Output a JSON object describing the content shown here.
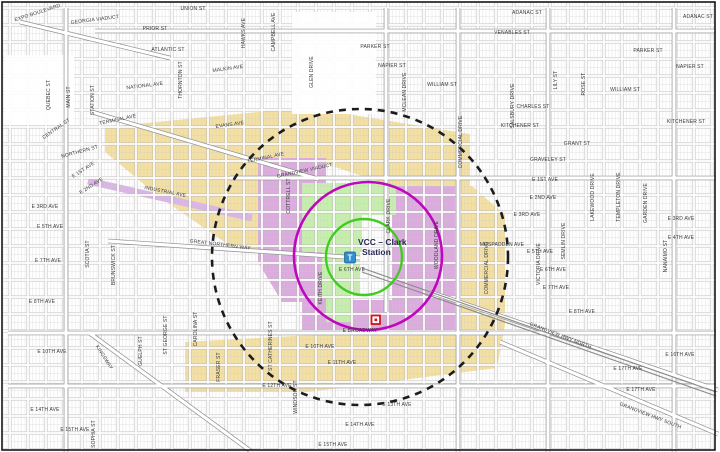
{
  "map": {
    "station": {
      "line1": "VCC – Clark",
      "line2": "Station",
      "icon_letter": "T"
    },
    "circles": {
      "inner": {
        "color": "#3fcb1f"
      },
      "middle": {
        "color": "#bd08bd"
      },
      "outer": {
        "color": "#1c1c1c"
      }
    },
    "zone_colors": {
      "tan": "#f4e0a1",
      "purple": "#dcaade",
      "green": "#c6efac",
      "lavender": "#dab4e6"
    },
    "marker_color": "#cf1418",
    "station_icon_color": "#2f8fd0",
    "street_labels": [
      {
        "t": "EXPO BOULEVARD",
        "x": 38,
        "y": 14,
        "r": -18
      },
      {
        "t": "GEORGIA VIADUCT",
        "x": 95,
        "y": 21,
        "r": -7
      },
      {
        "t": "UNION ST",
        "x": 193,
        "y": 10,
        "r": 0
      },
      {
        "t": "ADANAC ST",
        "x": 527,
        "y": 14,
        "r": 0
      },
      {
        "t": "ADANAC ST",
        "x": 698,
        "y": 18,
        "r": 0
      },
      {
        "t": "PRIOR ST",
        "x": 155,
        "y": 30,
        "r": 0
      },
      {
        "t": "VENABLES ST",
        "x": 512,
        "y": 34,
        "r": 0
      },
      {
        "t": "ATLANTIC ST",
        "x": 168,
        "y": 51,
        "r": 0
      },
      {
        "t": "MALKIN AVE",
        "x": 228,
        "y": 70,
        "r": -8
      },
      {
        "t": "PARKER ST",
        "x": 375,
        "y": 48,
        "r": 0
      },
      {
        "t": "PARKER ST",
        "x": 648,
        "y": 52,
        "r": 0
      },
      {
        "t": "NAPIER ST",
        "x": 392,
        "y": 67,
        "r": 0
      },
      {
        "t": "NAPIER ST",
        "x": 690,
        "y": 68,
        "r": 0
      },
      {
        "t": "WILLIAM ST",
        "x": 442,
        "y": 86,
        "r": 0
      },
      {
        "t": "WILLIAM ST",
        "x": 625,
        "y": 91,
        "r": 0
      },
      {
        "t": "CHARLES ST",
        "x": 533,
        "y": 108,
        "r": 0
      },
      {
        "t": "KITCHENER ST",
        "x": 520,
        "y": 127,
        "r": 0
      },
      {
        "t": "KITCHENER ST",
        "x": 686,
        "y": 123,
        "r": 0
      },
      {
        "t": "GRANT ST",
        "x": 577,
        "y": 145,
        "r": 0
      },
      {
        "t": "GRAVELEY ST",
        "x": 548,
        "y": 161,
        "r": 0
      },
      {
        "t": "NATIONAL AVE",
        "x": 145,
        "y": 87,
        "r": -7
      },
      {
        "t": "TERMINAL AVE",
        "x": 118,
        "y": 121,
        "r": -12
      },
      {
        "t": "TERMINAL AVE",
        "x": 266,
        "y": 159,
        "r": -12
      },
      {
        "t": "GRANDVIEW VIADUCT",
        "x": 305,
        "y": 172,
        "r": -12
      },
      {
        "t": "EVANS AVE",
        "x": 230,
        "y": 126,
        "r": -8
      },
      {
        "t": "NORTHERN ST",
        "x": 80,
        "y": 153,
        "r": -15
      },
      {
        "t": "CENTRAL ST",
        "x": 57,
        "y": 130,
        "r": -35
      },
      {
        "t": "INDUSTRIAL AVE",
        "x": 165,
        "y": 193,
        "r": 11
      },
      {
        "t": "GREAT NORTHERN WAY",
        "x": 220,
        "y": 246,
        "r": 7
      },
      {
        "t": "E 1ST AVE",
        "x": 545,
        "y": 181,
        "r": 0
      },
      {
        "t": "E 1ST AVE",
        "x": 84,
        "y": 171,
        "r": -33
      },
      {
        "t": "E 2ND AVE",
        "x": 543,
        "y": 199,
        "r": 0
      },
      {
        "t": "E 2ND AVE",
        "x": 92,
        "y": 187,
        "r": -33
      },
      {
        "t": "E 3RD AVE",
        "x": 527,
        "y": 216,
        "r": 0
      },
      {
        "t": "E 3RD AVE",
        "x": 681,
        "y": 220,
        "r": 0
      },
      {
        "t": "E 3RD AVE",
        "x": 45,
        "y": 208,
        "r": 0
      },
      {
        "t": "E 4TH AVE",
        "x": 681,
        "y": 239,
        "r": 0
      },
      {
        "t": "E 5TH AVE",
        "x": 50,
        "y": 228,
        "r": 0
      },
      {
        "t": "E 5TH AVE",
        "x": 540,
        "y": 253,
        "r": 0
      },
      {
        "t": "E 6TH AVE",
        "x": 352,
        "y": 271,
        "r": 0
      },
      {
        "t": "E 6TH AVE",
        "x": 553,
        "y": 271,
        "r": 0
      },
      {
        "t": "E 7TH AVE",
        "x": 48,
        "y": 262,
        "r": 0
      },
      {
        "t": "E 7TH AVE",
        "x": 556,
        "y": 289,
        "r": 0
      },
      {
        "t": "E 8TH AVE",
        "x": 42,
        "y": 303,
        "r": 0
      },
      {
        "t": "E 8TH AVE",
        "x": 582,
        "y": 313,
        "r": 0
      },
      {
        "t": "MCSPADDEN AVE",
        "x": 502,
        "y": 246,
        "r": 0
      },
      {
        "t": "E BROADWAY",
        "x": 360,
        "y": 332,
        "r": 0
      },
      {
        "t": "E 10TH AVE",
        "x": 320,
        "y": 348,
        "r": 0
      },
      {
        "t": "E 10TH AVE",
        "x": 52,
        "y": 353,
        "r": 0
      },
      {
        "t": "E 11TH AVE",
        "x": 342,
        "y": 364,
        "r": 0
      },
      {
        "t": "E 12TH AVE",
        "x": 277,
        "y": 387,
        "r": 0
      },
      {
        "t": "E 13TH AVE",
        "x": 397,
        "y": 406,
        "r": 0
      },
      {
        "t": "E 14TH AVE",
        "x": 45,
        "y": 411,
        "r": 0
      },
      {
        "t": "E 14TH AVE",
        "x": 360,
        "y": 426,
        "r": 0
      },
      {
        "t": "E 15TH AVE",
        "x": 75,
        "y": 431,
        "r": 0
      },
      {
        "t": "E 15TH AVE",
        "x": 333,
        "y": 446,
        "r": 0
      },
      {
        "t": "E 16TH AVE",
        "x": 680,
        "y": 356,
        "r": 0
      },
      {
        "t": "E 17TH AVE",
        "x": 628,
        "y": 370,
        "r": 0
      },
      {
        "t": "E 17TH AVE",
        "x": 641,
        "y": 391,
        "r": 0
      },
      {
        "t": "KINGSWAY",
        "x": 103,
        "y": 358,
        "r": 57
      },
      {
        "t": "GRANDVIEW HWY NORTH",
        "x": 560,
        "y": 337,
        "r": 21
      },
      {
        "t": "GRANDVIEW HWY SOUTH",
        "x": 650,
        "y": 417,
        "r": 21
      },
      {
        "t": "QUEBEC ST",
        "x": 50,
        "y": 95,
        "r": -90
      },
      {
        "t": "MAIN ST",
        "x": 70,
        "y": 97,
        "r": -90
      },
      {
        "t": "STATION ST",
        "x": 94,
        "y": 100,
        "r": -90
      },
      {
        "t": "THORNTON ST",
        "x": 182,
        "y": 80,
        "r": -90
      },
      {
        "t": "COTTRELL ST",
        "x": 290,
        "y": 196,
        "r": -90
      },
      {
        "t": "HAWKS AVE",
        "x": 245,
        "y": 33,
        "r": -90
      },
      {
        "t": "CAMPBELL AVE",
        "x": 275,
        "y": 32,
        "r": -90
      },
      {
        "t": "GLEN DRIVE",
        "x": 313,
        "y": 72,
        "r": -90
      },
      {
        "t": "CLARK DRIVE",
        "x": 390,
        "y": 216,
        "r": -90
      },
      {
        "t": "MCLEAN DRIVE",
        "x": 406,
        "y": 92,
        "r": -90
      },
      {
        "t": "WOODLAND DRIVE",
        "x": 438,
        "y": 245,
        "r": -90
      },
      {
        "t": "COMMERCIAL DRIVE",
        "x": 462,
        "y": 142,
        "r": -90
      },
      {
        "t": "COMMERCIAL DRIVE",
        "x": 488,
        "y": 268,
        "r": -90
      },
      {
        "t": "SALSBURY DRIVE",
        "x": 514,
        "y": 106,
        "r": -90
      },
      {
        "t": "SEMLIN DRIVE",
        "x": 565,
        "y": 241,
        "r": -90
      },
      {
        "t": "VICTORIA DRIVE",
        "x": 540,
        "y": 264,
        "r": -90
      },
      {
        "t": "LAKEWOOD DRIVE",
        "x": 594,
        "y": 197,
        "r": -90
      },
      {
        "t": "TEMPLETON DRIVE",
        "x": 620,
        "y": 197,
        "r": -90
      },
      {
        "t": "GARDEN DRIVE",
        "x": 647,
        "y": 203,
        "r": -90
      },
      {
        "t": "NANAIMO ST",
        "x": 667,
        "y": 256,
        "r": -90
      },
      {
        "t": "LILY ST",
        "x": 557,
        "y": 80,
        "r": -90
      },
      {
        "t": "ROSE ST",
        "x": 585,
        "y": 84,
        "r": -90
      },
      {
        "t": "KEITH DRIVE",
        "x": 322,
        "y": 288,
        "r": -90
      },
      {
        "t": "SCOTIA ST",
        "x": 89,
        "y": 254,
        "r": -90
      },
      {
        "t": "BRUNSWICK ST",
        "x": 115,
        "y": 265,
        "r": -90
      },
      {
        "t": "ST GEORGE ST",
        "x": 167,
        "y": 335,
        "r": -90
      },
      {
        "t": "CAROLINA ST",
        "x": 197,
        "y": 329,
        "r": -90
      },
      {
        "t": "FRASER ST",
        "x": 220,
        "y": 367,
        "r": -90
      },
      {
        "t": "GUELPH ST",
        "x": 142,
        "y": 351,
        "r": -90
      },
      {
        "t": "SOPHIA ST",
        "x": 95,
        "y": 434,
        "r": -90
      },
      {
        "t": "ST CATHERINES ST",
        "x": 272,
        "y": 346,
        "r": -90
      },
      {
        "t": "WINDSOR ST",
        "x": 297,
        "y": 397,
        "r": -90
      }
    ]
  }
}
